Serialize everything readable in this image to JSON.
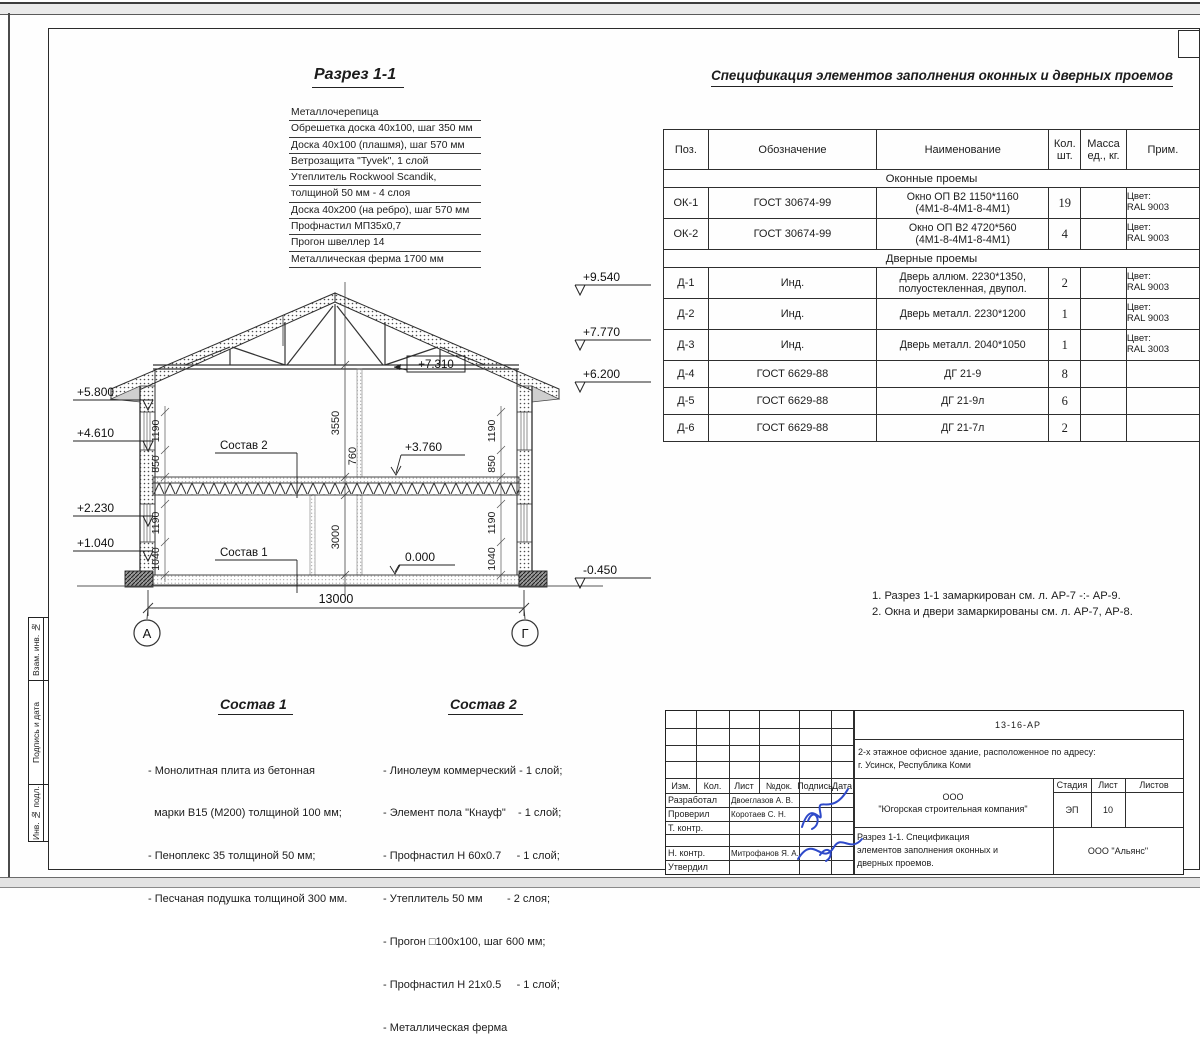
{
  "titles": {
    "section": "Разрез 1-1",
    "spec": "Спецификация элементов заполнения оконных и дверных проемов"
  },
  "roof_callout": {
    "items": [
      "Металлочерепица",
      "Обрешетка доска 40х100, шаг 350 мм",
      "Доска 40х100 (плашмя), шаг 570 мм",
      "Ветрозащита \"Tyvek\", 1 слой",
      "Утеплитель Rockwool Scandik,",
      "толщиной 50 мм - 4 слоя",
      "Доска 40х200 (на ребро), шаг 570 мм",
      "Профнастил МП35х0,7",
      "Прогон швеллер 14",
      "Металлическая ферма 1700 мм"
    ]
  },
  "spec_table": {
    "headers": {
      "pos": "Поз.",
      "desig": "Обозначение",
      "name": "Наименование",
      "qty": "Кол.\nшт.",
      "mass": "Масса\nед., кг.",
      "note": "Прим."
    },
    "groups": [
      {
        "title": "Оконные проемы",
        "rows": [
          {
            "pos": "ОК-1",
            "desig": "ГОСТ 30674-99",
            "name": "Окно ОП В2 1150*1160\n(4М1-8-4М1-8-4М1)",
            "qty": "19",
            "mass": "",
            "note": "Цвет:\nRAL 9003"
          },
          {
            "pos": "ОК-2",
            "desig": "ГОСТ 30674-99",
            "name": "Окно ОП В2 4720*560\n(4М1-8-4М1-8-4М1)",
            "qty": "4",
            "mass": "",
            "note": "Цвет:\nRAL 9003"
          }
        ]
      },
      {
        "title": "Дверные проемы",
        "rows": [
          {
            "pos": "Д-1",
            "desig": "Инд.",
            "name": "Дверь аллюм. 2230*1350,\nполуостекленная, двупол.",
            "qty": "2",
            "mass": "",
            "note": "Цвет:\nRAL 9003"
          },
          {
            "pos": "Д-2",
            "desig": "Инд.",
            "name": "Дверь металл. 2230*1200",
            "qty": "1",
            "mass": "",
            "note": "Цвет:\nRAL 9003"
          },
          {
            "pos": "Д-3",
            "desig": "Инд.",
            "name": "Дверь металл. 2040*1050",
            "qty": "1",
            "mass": "",
            "note": "Цвет:\nRAL 3003"
          },
          {
            "pos": "Д-4",
            "desig": "ГОСТ 6629-88",
            "name": "ДГ 21-9",
            "qty": "8",
            "mass": "",
            "note": ""
          },
          {
            "pos": "Д-5",
            "desig": "ГОСТ 6629-88",
            "name": "ДГ 21-9л",
            "qty": "6",
            "mass": "",
            "note": ""
          },
          {
            "pos": "Д-6",
            "desig": "ГОСТ 6629-88",
            "name": "ДГ 21-7л",
            "qty": "2",
            "mass": "",
            "note": ""
          }
        ]
      }
    ]
  },
  "notes": [
    "1. Разрез 1-1 замаркирован см. л. АР-7 -:- АР-9.",
    "2. Окна и двери замаркированы см. л. АР-7, АР-8."
  ],
  "drawing": {
    "e9540": "+9.540",
    "e7770": "+7.770",
    "e6200": "+6.200",
    "e5800": "+5.800",
    "e4610": "+4.610",
    "e2230": "+2.230",
    "e1040": "+1.040",
    "e7310": "+7.310",
    "e3760": "+3.760",
    "e0000": "0.000",
    "em0450": "-0.450",
    "d13000": "13000",
    "d3550": "3550",
    "d760": "760",
    "d3000": "3000",
    "d850": "850",
    "d1190": "1190",
    "d1040": "1040",
    "axisA": "А",
    "axisG": "Г"
  },
  "sostav1": {
    "title": "Состав 1",
    "items": [
      "- Монолитная плита из бетонная",
      "  марки В15 (М200) толщиной 100 мм;",
      "- Пеноплекс 35 толщиной 50 мм;",
      "- Песчаная подушка толщиной 300 мм."
    ]
  },
  "sostav2": {
    "title": "Состав 2",
    "items": [
      "- Линолеум коммерческий - 1 слой;",
      "- Элемент пола \"Кнауф\"    - 1 слой;",
      "- Профнастил Н 60х0.7     - 1 слой;",
      "- Утеплитель 50 мм        - 2 слоя;",
      "- Прогон □100х100, шаг 600 мм;",
      "- Профнастил Н 21х0.5     - 1 слой;",
      "- Металлическая ферма"
    ]
  },
  "sidebar": [
    "Взам. инв. №",
    "Подпись и дата",
    "Инв. № подл."
  ],
  "titleblock": {
    "doc_code": "13-16-АР",
    "project": "2-х этажное офисное здание, расположенное по адресу:\nг. Усинск, Республика Коми",
    "company": "ООО\n\"Югорская строительная компания\"",
    "sheet_title": "Разрез 1-1. Спецификация\nэлементов заполнения оконных и\nдверных проемов.",
    "contractor": "ООО \"Альянс\"",
    "stage_label": "Стадия",
    "sheet_label": "Лист",
    "sheets_label": "Листов",
    "stage": "ЭП",
    "sheet_num": "10",
    "cols": [
      "Изм.",
      "Кол.",
      "Лист",
      "№док.",
      "Подпись",
      "Дата"
    ],
    "roles": [
      {
        "role": "Разработал",
        "name": "Двоеглазов А. В."
      },
      {
        "role": "Проверил",
        "name": "Коротаев С. Н."
      },
      {
        "role": "Т. контр.",
        "name": ""
      },
      {
        "role": "",
        "name": ""
      },
      {
        "role": "Н. контр.",
        "name": "Митрофанов Я. А."
      },
      {
        "role": "Утвердил",
        "name": ""
      }
    ]
  }
}
